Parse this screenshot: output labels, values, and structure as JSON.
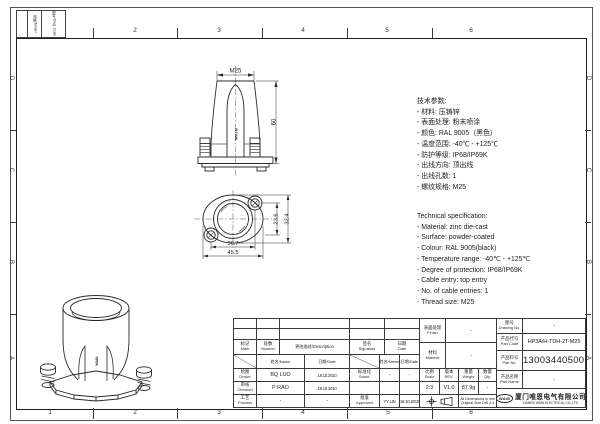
{
  "colors": {
    "ink": "#2a2a2a",
    "background": "#ffffff"
  },
  "frame": {
    "zone_numbers": [
      "1",
      "2",
      "3",
      "4",
      "5",
      "6"
    ],
    "zone_letters": [
      "D",
      "C",
      "B",
      "A"
    ],
    "corner_cells": [
      "规格/Model",
      "图号/Dwg. Code"
    ]
  },
  "views": {
    "front": {
      "thread_dim": "M25",
      "height_dim": "60",
      "brand": "WAIN"
    },
    "top": {
      "dim_inner_width": "36.7",
      "dim_outer_width": "45.5",
      "dim_inner_height": "23.6",
      "dim_outer_height": "32.4"
    },
    "iso": {
      "brand": "WAIN"
    }
  },
  "specs_cn": {
    "title": "技术参数:",
    "items": [
      "- 材料: 压铸锌",
      "- 表面处理: 粉末喷涂",
      "- 颜色: RAL 9005（黑色）",
      "- 温度范围: -40℃ - +125℃",
      "- 防护等级: IP68/IP69K",
      "- 出线方向: 顶出线",
      "- 出线孔数: 1",
      "- 螺纹规格: M25"
    ]
  },
  "specs_en": {
    "title": "Technical specification:",
    "items": [
      "- Material: zinc die-cast",
      "- Surface: powder-coated",
      "- Colour: RAL 9005(black)",
      "- Temperature range: -40℃ - +125℃",
      "- Degree of protection: IP68/IP69K",
      "- Cable entry: top entry",
      "- No. of cable entries: 1",
      "- Thread size: M25"
    ]
  },
  "title_block": {
    "revision": {
      "mark": {
        "cn": "标记",
        "en": "Mark"
      },
      "number": {
        "cn": "处数",
        "en": "Number"
      },
      "description": "更改描述/Description",
      "signature": {
        "cn": "签名",
        "en": "Signature"
      },
      "date_hdr": {
        "cn": "日期",
        "en": "Date"
      },
      "name_sub": "姓名/Name",
      "date_sub": "日期/Date"
    },
    "sign_rows": {
      "drawn": {
        "cn": "绘图",
        "en": "Drawn",
        "name": "BQ LUO",
        "date": "18.10.2010"
      },
      "stand": {
        "cn": "标准化",
        "en": "Stand.",
        "name": "-",
        "date": "-"
      },
      "checked": {
        "cn": "审核",
        "en": "Checked",
        "name": "P RAO",
        "date": "18.10.2010"
      },
      "process": {
        "cn": "工艺",
        "en": "Process",
        "name": "-",
        "date": "-"
      },
      "approved": {
        "cn": "批准",
        "en": "Approved",
        "name": "YY LIN",
        "date": "18.10.2010"
      }
    },
    "middle": {
      "finish": {
        "cn": "表面处理",
        "en": "Finish",
        "value": "-"
      },
      "material": {
        "cn": "材料",
        "en": "Material",
        "value": "-"
      },
      "scale": {
        "cn": "比例",
        "en": "Scale",
        "value": "2:3"
      },
      "rev": {
        "cn": "版本",
        "en": "REV.",
        "value": "V1.0"
      },
      "weight": {
        "cn": "重量",
        "en": "Weight",
        "value": "87.9g"
      },
      "qty": {
        "cn": "数量",
        "en": "Qty.",
        "value": "-"
      },
      "note_line1": "All Dimensions in mm",
      "note_line2": "Original Size DIN A 4"
    },
    "right": {
      "drawing_no": {
        "cn": "图号",
        "en": "Drawing No.",
        "value": "-"
      },
      "part_code": {
        "cn": "产品代号",
        "en": "Part Code",
        "value": "HP3A/H-TDH-2T-M25"
      },
      "part_no": {
        "cn": "产品料号",
        "en": "Part No.",
        "value": "1130034405003"
      },
      "part_name": {
        "cn": "产品名称",
        "en": "Part Name",
        "value": "-"
      },
      "company": {
        "logo": "WAIN",
        "name_cn": "厦门唯恩电气有限公司",
        "name_en": "XIAMEN WAIN ELECTRICAL CO.,LTD"
      }
    }
  }
}
